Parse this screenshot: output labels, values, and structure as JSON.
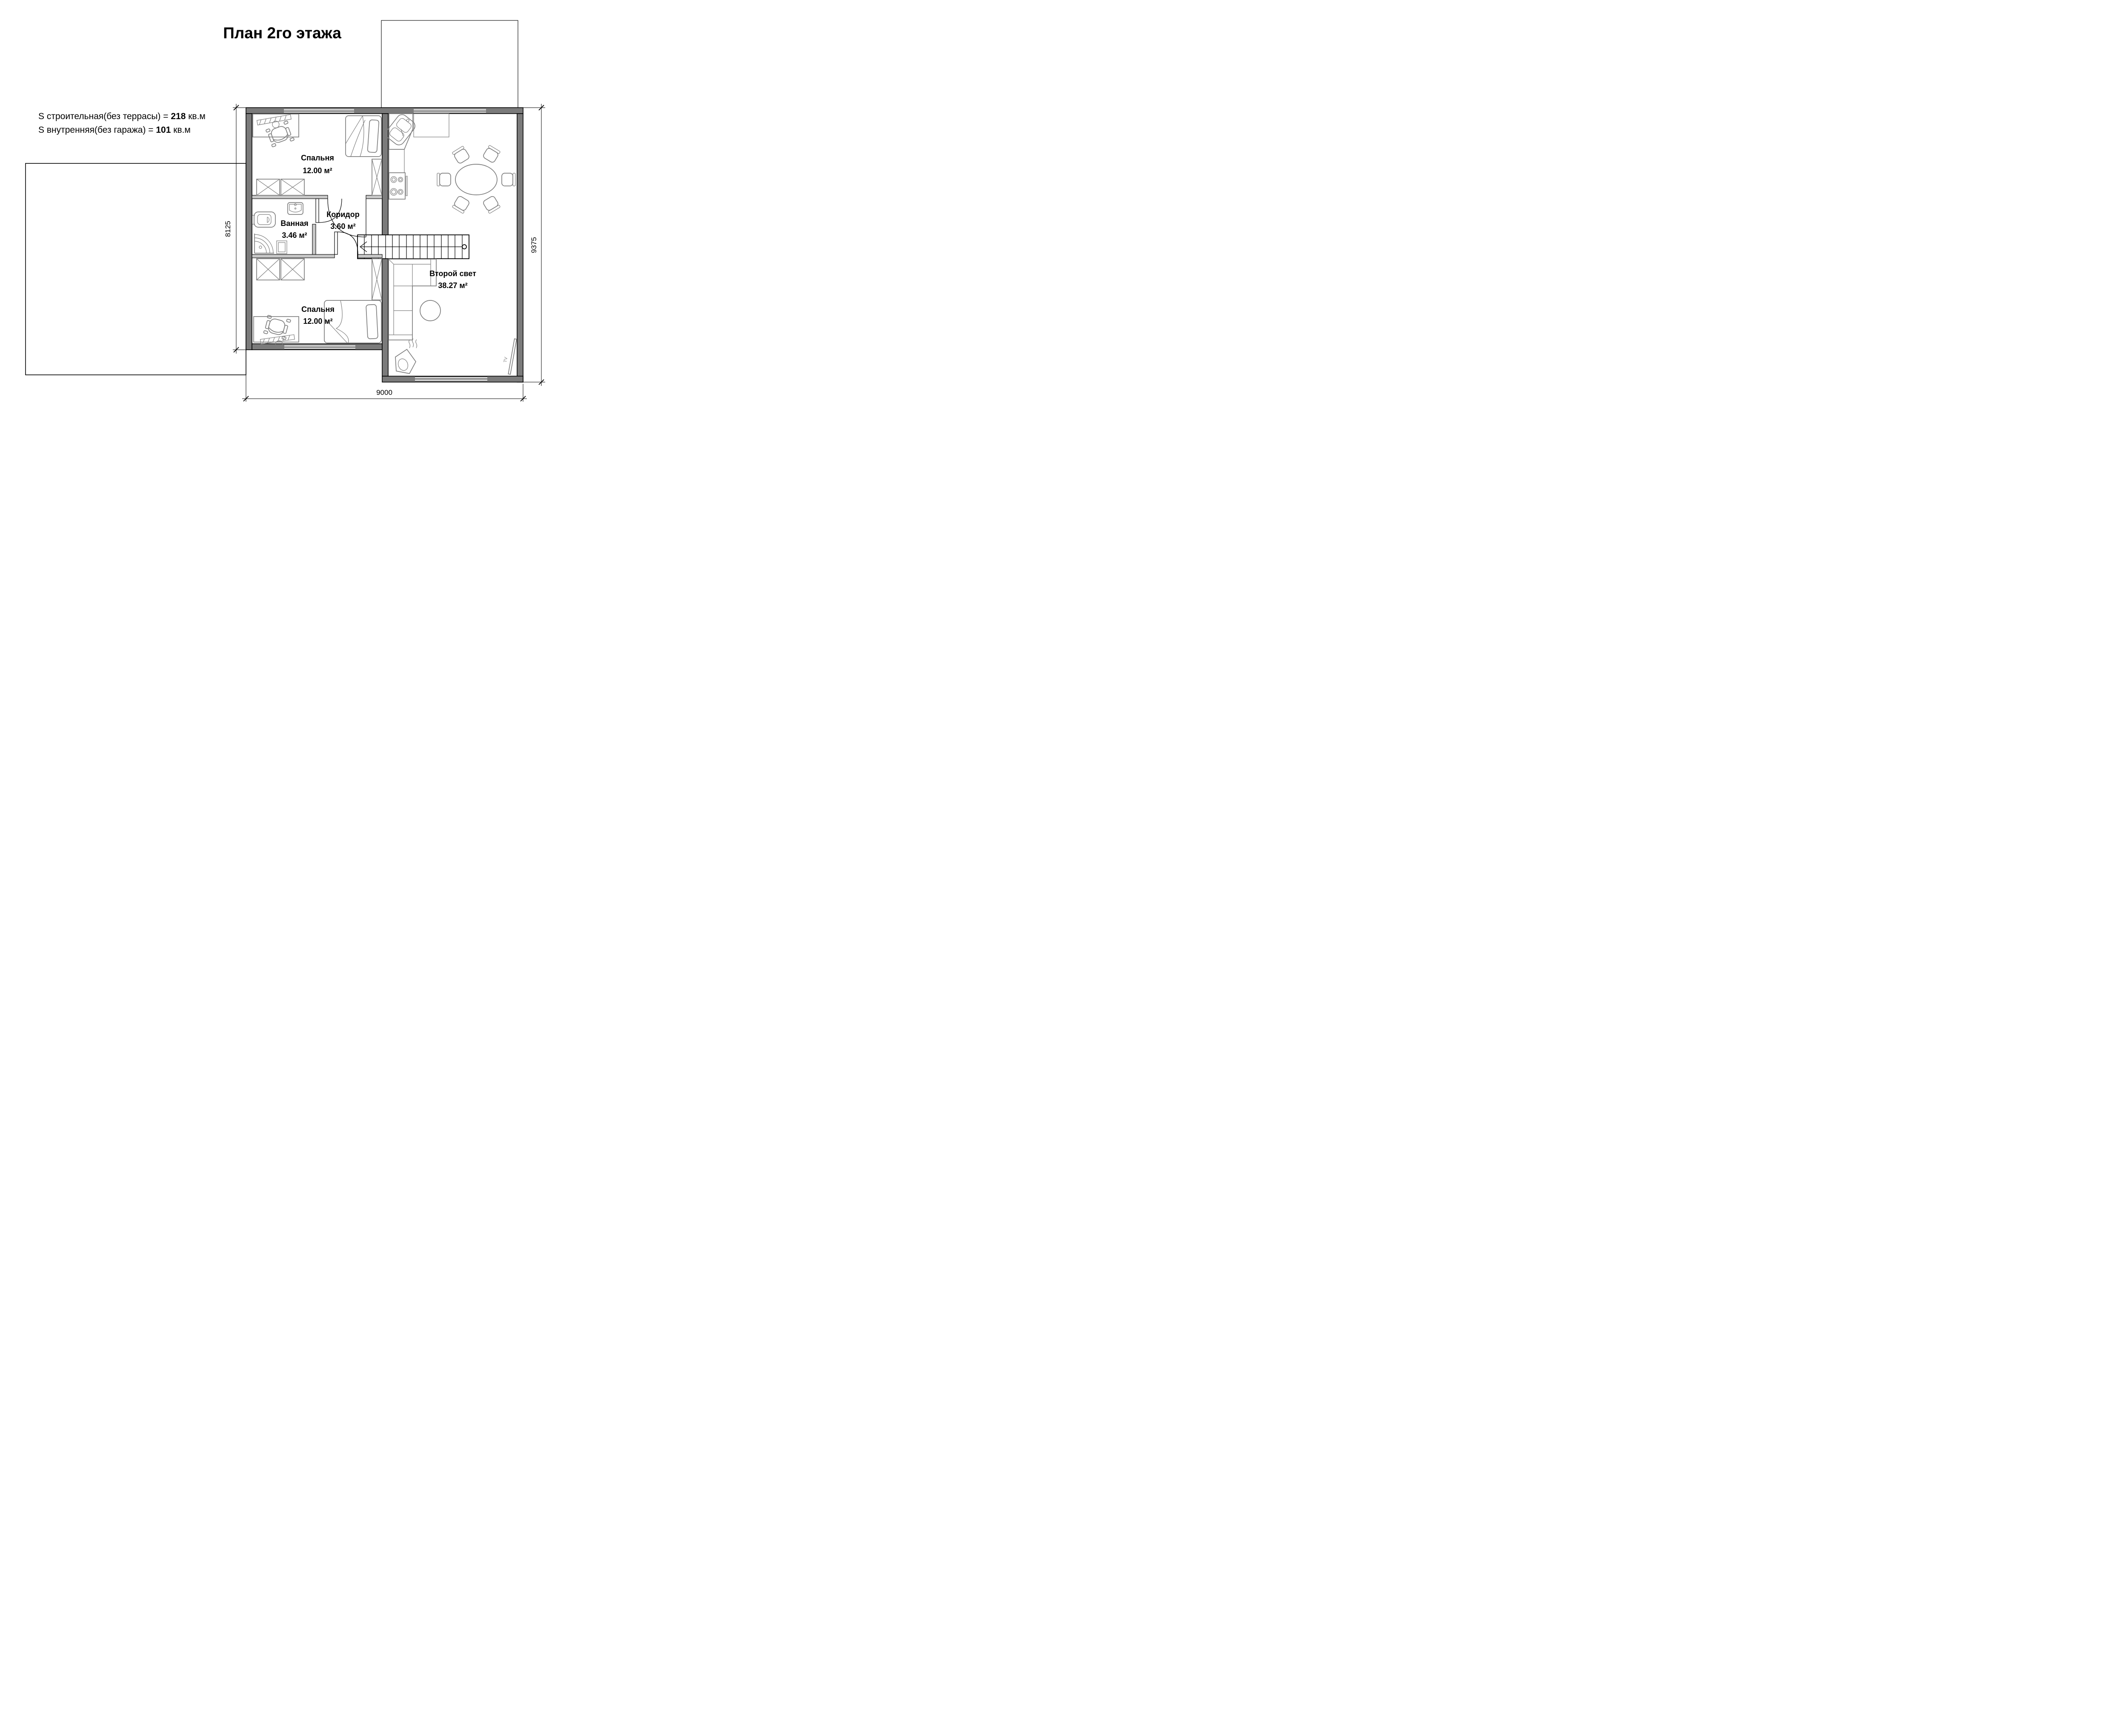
{
  "title": "План 2го этажа",
  "areas": {
    "line1": {
      "prefix": "S строительная(без террасы) = ",
      "value": "218",
      "suffix": " кв.м"
    },
    "line2": {
      "prefix": "S внутренняя(без гаража) = ",
      "value": "101",
      "suffix": " кв.м"
    }
  },
  "rooms": {
    "bedroom_top": {
      "name": "Спальня",
      "area": "12.00 м²"
    },
    "bathroom": {
      "name": "Ванная",
      "area": "3.46 м²"
    },
    "corridor": {
      "name": "Коридор",
      "area": "3.60 м²"
    },
    "bedroom_bottom": {
      "name": "Спальня",
      "area": "12.00 м²"
    },
    "living": {
      "name": "Второй свет",
      "area": "38.27 м²"
    }
  },
  "dimensions": {
    "left": "8125",
    "right": "9375",
    "bottom": "9000"
  },
  "tv_label": "TV",
  "colors": {
    "wall_dark": "#7b7b7b",
    "wall_light": "#c7c7c7",
    "furniture": "#7e7e7e",
    "line": "#000000"
  }
}
